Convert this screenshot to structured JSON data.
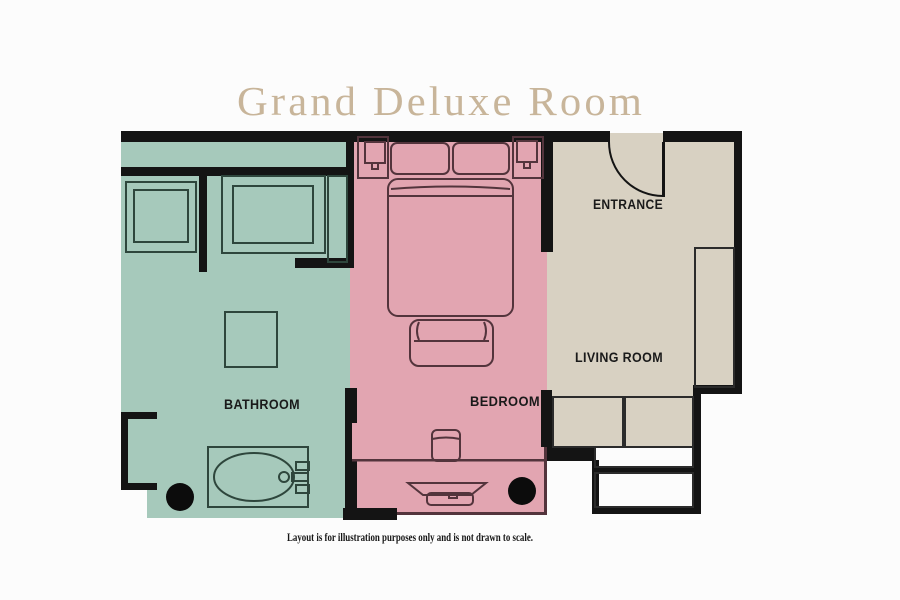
{
  "title": "Grand Deluxe Room",
  "disclaimer": "Layout is for illustration purposes only and is not drawn to scale.",
  "rooms": {
    "bathroom": {
      "label": "BATHROOM"
    },
    "bedroom": {
      "label": "BEDROOM"
    },
    "entrance": {
      "label": "ENTRANCE"
    },
    "living_room": {
      "label": "LIVING ROOM"
    }
  },
  "colors": {
    "bathroom_fill": "#a6c9bb",
    "bedroom_fill": "#e2a5b1",
    "living_fill": "#d8d1c2",
    "wall": "#141414",
    "title": "#c8b59a",
    "label": "#1a1a1a",
    "bath_outline": "#2e463c",
    "bed_outline": "#53343c",
    "living_outline": "#2b2b2b",
    "background": "#fcfcfc"
  }
}
